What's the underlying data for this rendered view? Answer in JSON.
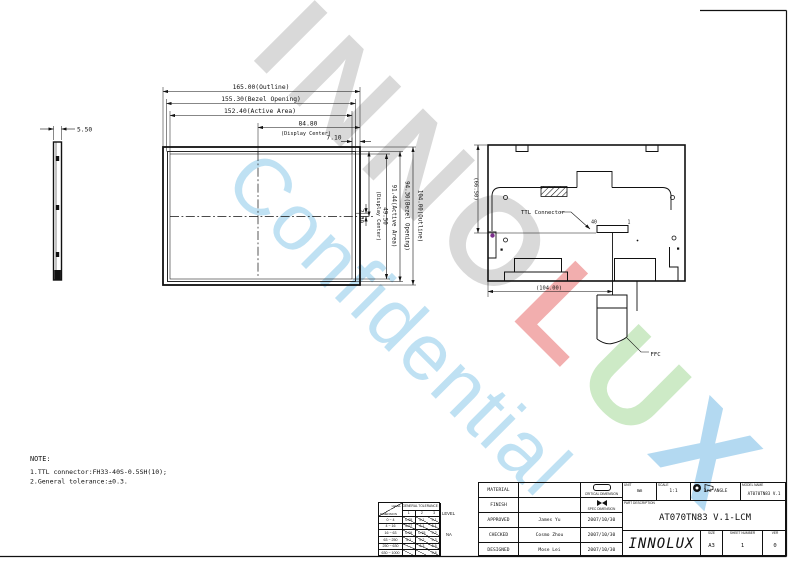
{
  "watermark": {
    "letters": [
      "I",
      "N",
      "N",
      "O",
      "L",
      "U",
      "X"
    ],
    "letter_colors": [
      "#d9d9d9",
      "#d9d9d9",
      "#d9d9d9",
      "#d9d9d9",
      "#f2aeae",
      "#cdeac6",
      "#b3d9f1"
    ],
    "confidential": "Confidential",
    "confidential_color": "#bfe1f3"
  },
  "drawing": {
    "front_view": {
      "dim_outline": "165.00(Outline)",
      "dim_bezel": "155.30(Bezel Opening)",
      "dim_active": "152.40(Active Area)",
      "dim_display_center_h": "84.80",
      "display_center_caption_h": "(Display Center)",
      "dim_offset": "7.10",
      "dim_v_offset": "2.30",
      "dim_v_display_center": "49.50",
      "display_center_caption_v": "(Display Center)",
      "dim_v_active": "91.44(Active Area)",
      "dim_v_bezel": "94.30(Bezel Opening)",
      "dim_v_outline": "104.00(Outline)"
    },
    "side_view": {
      "dim_thickness": "5.50"
    },
    "back_view": {
      "dim_height": "(66.50)",
      "dim_width": "(104.00)",
      "connector_label": "TTL Connector",
      "pin_40": "40",
      "pin_1": "1",
      "ffc_label": "FFC"
    },
    "note": {
      "title": "NOTE:",
      "line1": "1.TTL connector:FH33-40S-0.5SH(10);",
      "line2": "2.General tolerance:±0.3."
    }
  },
  "tolerance_table": {
    "corner_level": "LEVEL",
    "corner_dimension": "DIMENSION",
    "header": "GENERAL TOLERANCE ±",
    "cols": [
      "1",
      "2",
      "3"
    ],
    "rows": [
      {
        "range": "0 ~ 4",
        "v1": "0.05",
        "v2": "0.1",
        "v3": "0.1"
      },
      {
        "range": "4 ~ 16",
        "v1": "0.07",
        "v2": "0.1",
        "v3": "0.1"
      },
      {
        "range": "16 ~ 63",
        "v1": "0.09",
        "v2": "0.15",
        "v3": "0.2"
      },
      {
        "range": "63 ~ 250",
        "v1": "0.1",
        "v2": "0.2",
        "v3": "0.3"
      },
      {
        "range": "250 ~ 630",
        "v1": "",
        "v2": "0.3",
        "v3": "0.5"
      },
      {
        "range": "630 ~ 1000",
        "v1": "",
        "v2": "",
        "v3": "0.8"
      }
    ],
    "side_level": "LEVEL",
    "side_na": "NA"
  },
  "title_block": {
    "material_label": "MATERIAL",
    "finish_label": "FINISH",
    "approved_label": "APPROVED",
    "checked_label": "CHECKED",
    "designed_label": "DESIGNED",
    "approved_name": "James Yu",
    "checked_name": "Cosmo Zhou",
    "designed_name": "Mose Lei",
    "approved_date": "2007/10/30",
    "checked_date": "2007/10/30",
    "designed_date": "2007/10/30",
    "critical_dim_label": "CRITICAL DIMENSION",
    "spec_dim_label": "SPEC DIMENSION",
    "unit_label": "UNIT",
    "unit_value": "mm",
    "scale_label": "SCALE",
    "scale_value": "1:1",
    "angle_label": "3rd ANGLE",
    "model_label": "MODEL NAME",
    "model_value": "AT070TN83 V.1",
    "part_desc_label": "PART DESCRIPTION",
    "part_desc_value": "AT070TN83 V.1-LCM",
    "logo": "INNOLUX",
    "size_label": "SIZE",
    "size_value": "A3",
    "sheet_label": "SHEET NUMBER",
    "sheet_value": "1",
    "ver_label": "VER",
    "ver_value": "0"
  }
}
